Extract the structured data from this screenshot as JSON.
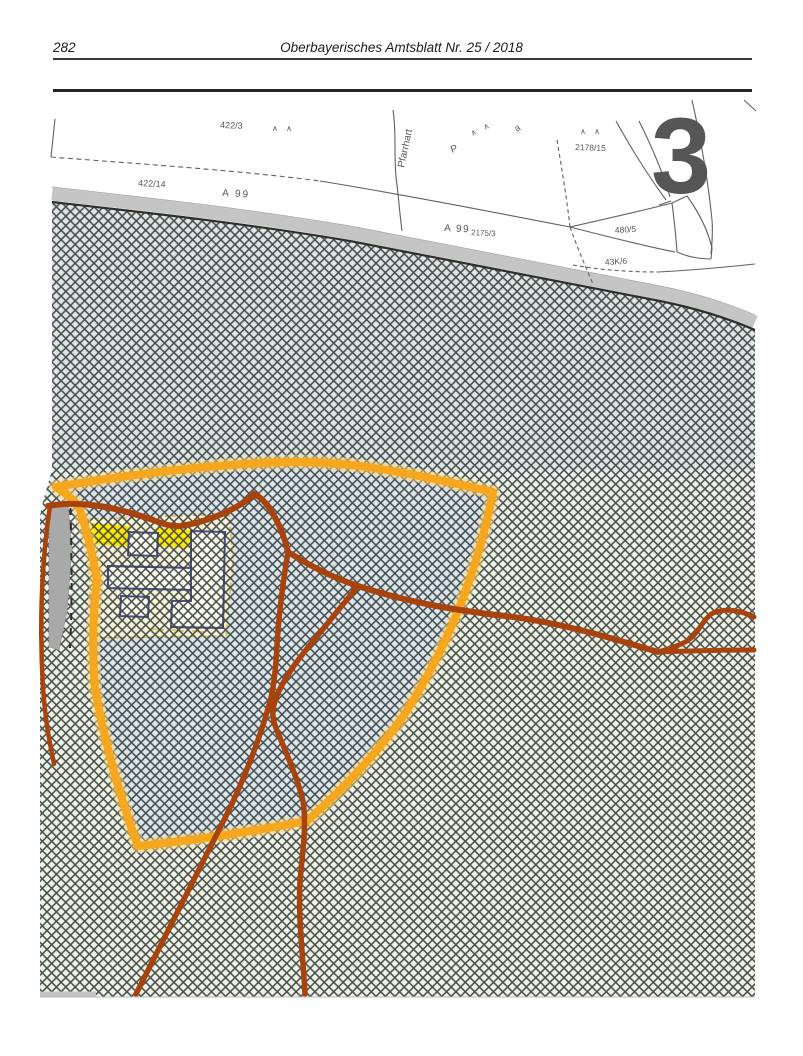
{
  "header": {
    "page_number": "282",
    "title": "Oberbayerisches Amtsblatt Nr. 25 / 2018"
  },
  "map": {
    "figure_number": "3",
    "tree_symbol": "∧ ∧",
    "labels": {
      "parcel_422_3": "422/3",
      "parcel_422_14": "422/14",
      "autobahn_left": "A 99",
      "street_pfarrhart": "Pfarrhart",
      "letter_p": "P",
      "letter_a": "a",
      "parcel_2178_15": "2178/15",
      "autobahn_right": "A 99",
      "parcel_2175_3": "2175/3",
      "parcel_480_5": "480/5",
      "parcel_43k_6": "43K/6"
    },
    "colors": {
      "plan_boundary_orange": "#F6A71E",
      "road_brown": "#A8430E",
      "highlight_yellow": "#FFE800",
      "building_blue": "#4C4C8F",
      "autobahn_gray": "#C5C5C5",
      "hatch_line": "#39413A"
    }
  }
}
